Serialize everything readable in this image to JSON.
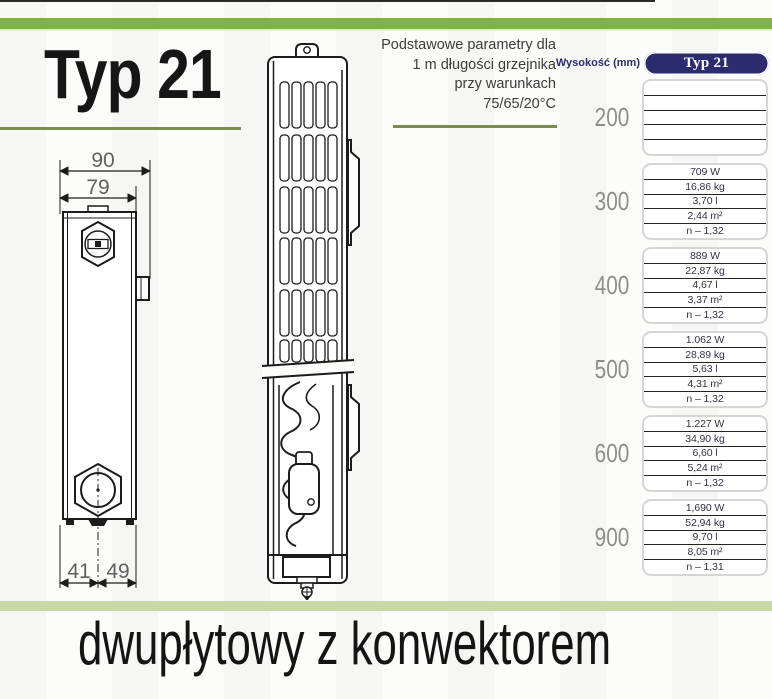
{
  "page": {
    "title": "Typ 21",
    "footer_caption": "dwupłytowy z konwektorem"
  },
  "params_note": {
    "line1": "Podstawowe parametry dla",
    "line2": "1 m długości grzejnika",
    "line3": "przy warunkach",
    "line4": "75/65/20°C"
  },
  "table": {
    "height_axis_label": "Wysokość (mm)",
    "column_header": "Typ 21",
    "rows": [
      {
        "height": "200",
        "values": [
          "",
          "",
          "",
          "",
          ""
        ]
      },
      {
        "height": "300",
        "values": [
          "709 W",
          "16,86 kg",
          "3,70 l",
          "2,44 m²",
          "n – 1,32"
        ]
      },
      {
        "height": "400",
        "values": [
          "889 W",
          "22,87 kg",
          "4,67 l",
          "3,37 m²",
          "n – 1,32"
        ]
      },
      {
        "height": "500",
        "values": [
          "1.062 W",
          "28,89 kg",
          "5,63 l",
          "4,31 m²",
          "n – 1,32"
        ]
      },
      {
        "height": "600",
        "values": [
          "1.227 W",
          "34,90 kg",
          "6,60 l",
          "5,24 m²",
          "n – 1,32"
        ]
      },
      {
        "height": "900",
        "values": [
          "1,690 W",
          "52,94 kg",
          "9,70 l",
          "8,05 m²",
          "n – 1,31"
        ]
      }
    ]
  },
  "drawing": {
    "dims": {
      "top_outer": "90",
      "top_inner": "79",
      "bottom_left": "41",
      "bottom_right": "49"
    }
  },
  "colors": {
    "accent_green": "#7cb544",
    "underline_olive": "#7c8c4e",
    "footer_green": "#c9d8a4",
    "navy": "#2b2b6e"
  }
}
